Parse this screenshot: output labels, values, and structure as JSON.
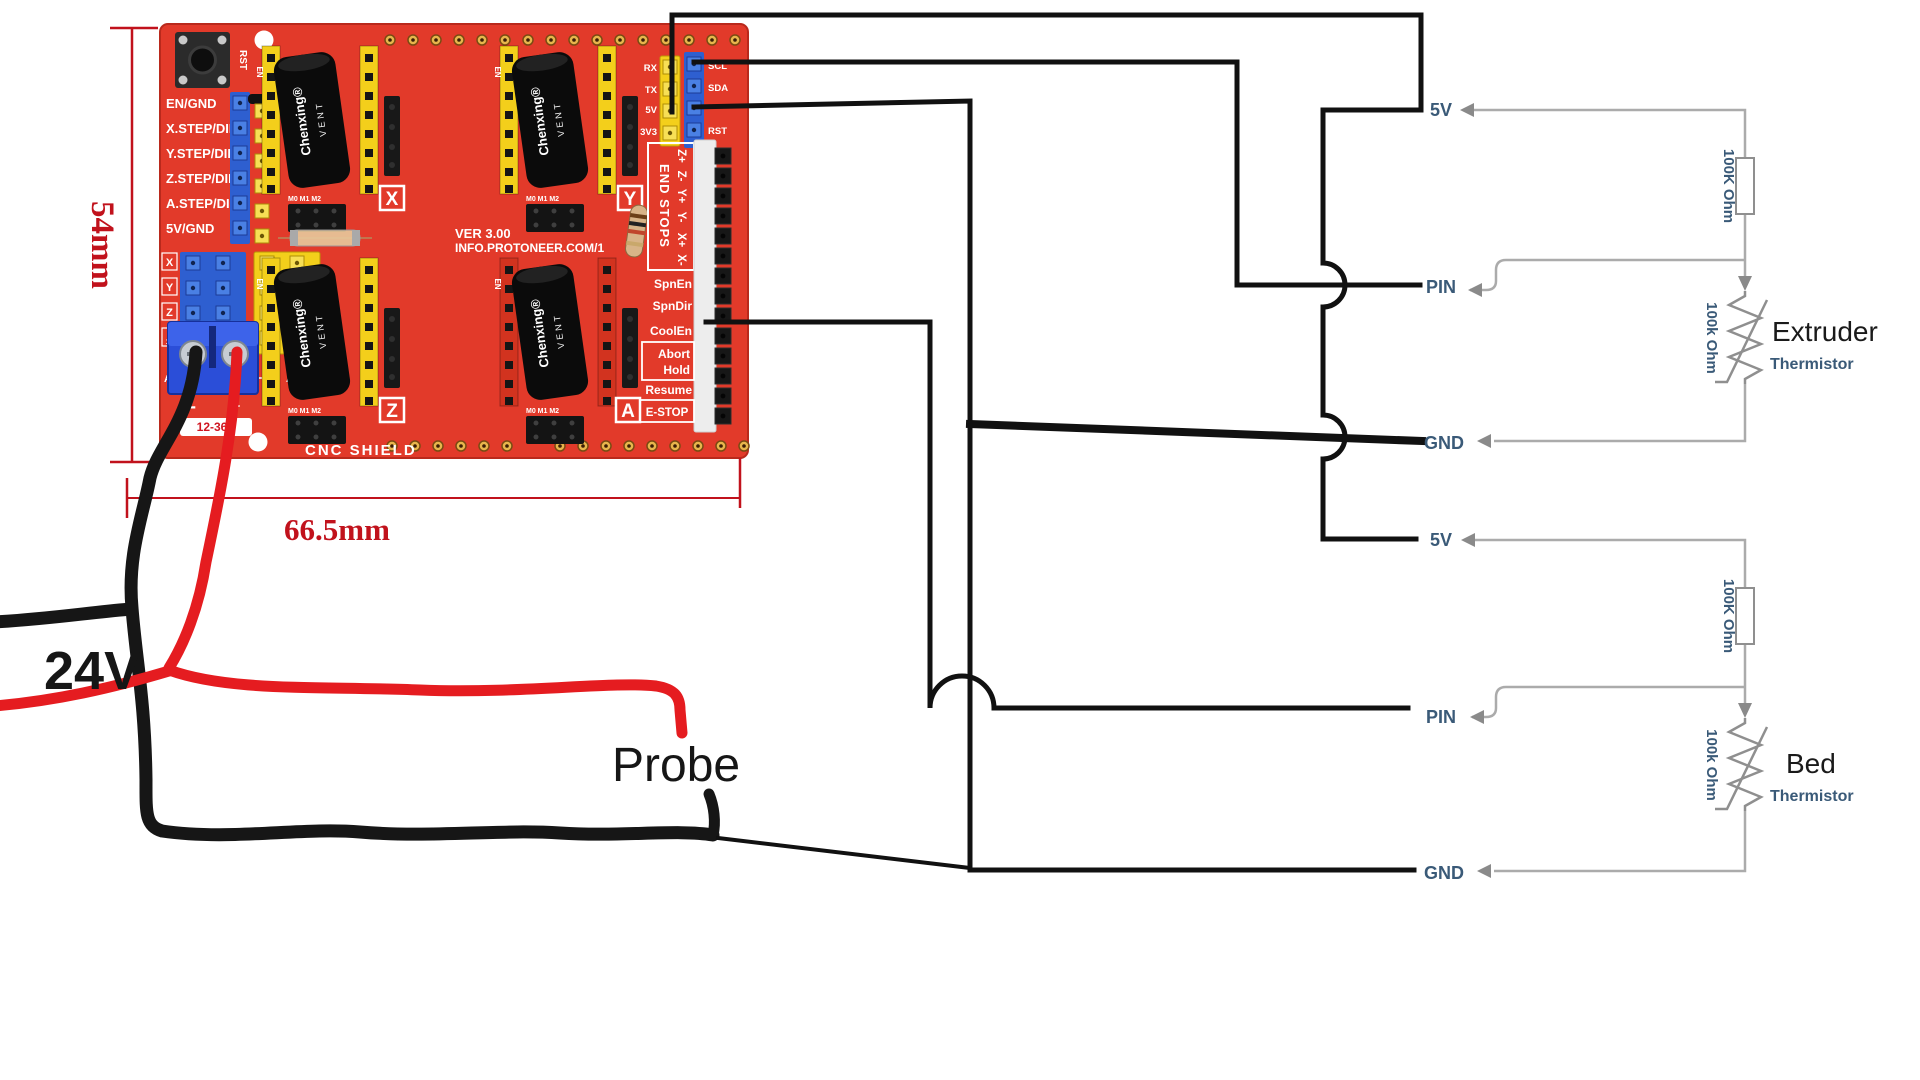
{
  "board": {
    "name": "CNC  SHIELD",
    "version": "VER 3.00",
    "url": "INFO.PROTONEER.COM/1",
    "reset_button": "RST",
    "left_pins": [
      "EN/GND",
      "X.STEP/DIR",
      "Y.STEP/DIR",
      "Z.STEP/DIR",
      "A.STEP/DIR",
      "5V/GND"
    ],
    "jumper_rows": [
      "X",
      "Y",
      "Z"
    ],
    "d12": {
      "top": "D",
      "bottom": "12"
    },
    "d13": {
      "top": "D",
      "bottom": "13"
    },
    "a_stp": "A.STP",
    "a_dir": "A.DIR",
    "serial_pins": [
      "RX",
      "TX",
      "5V",
      "3V3"
    ],
    "i2c_pins": [
      "SCL",
      "SDA",
      "RST"
    ],
    "endstops_title": "END STOPS",
    "endstop_pins": [
      "Z+",
      "Z-",
      "Y+",
      "Y-",
      "X+",
      "X-"
    ],
    "spindle_pins": [
      "SpnEn",
      "SpnDir",
      "CoolEn"
    ],
    "abort": "Abort",
    "hold": "Hold",
    "resume": "Resume",
    "estop": "E-STOP",
    "axis_boxes": [
      "X",
      "Y",
      "Z",
      "A"
    ],
    "driver_en": "EN",
    "ms_pins": "M0 M1 M2",
    "cap_brand": "Chenxing®",
    "cap_vent": "VENT",
    "terminal": {
      "minus": "-",
      "plus": "+",
      "voltage": "12-36V"
    }
  },
  "dimensions": {
    "height": "54mm",
    "width": "66.5mm"
  },
  "annotations": {
    "supply_voltage": "24V",
    "probe": "Probe"
  },
  "thermistor_circuits": [
    {
      "rail": "5V",
      "pin": "PIN",
      "ground": "GND",
      "series_resistor": "100K Ohm",
      "thermistor_resistance": "100k Ohm",
      "device": "Extruder",
      "component": "Thermistor"
    },
    {
      "rail": "5V",
      "pin": "PIN",
      "ground": "GND",
      "series_resistor": "100K Ohm",
      "thermistor_resistance": "100k Ohm",
      "device": "Bed",
      "component": "Thermistor"
    }
  ],
  "colors": {
    "pcb": "#e23a2a",
    "header_yellow": "#f3cf1b",
    "header_blue": "#2e5fd0",
    "driver_red": "#d2331f",
    "terminal_blue": "#2b4ed8",
    "wire_black": "#111111",
    "wire_red": "#e51c20",
    "schematic_gray": "#ababab",
    "label_blue": "#3a5a78",
    "dimension_red": "#c1121c"
  }
}
